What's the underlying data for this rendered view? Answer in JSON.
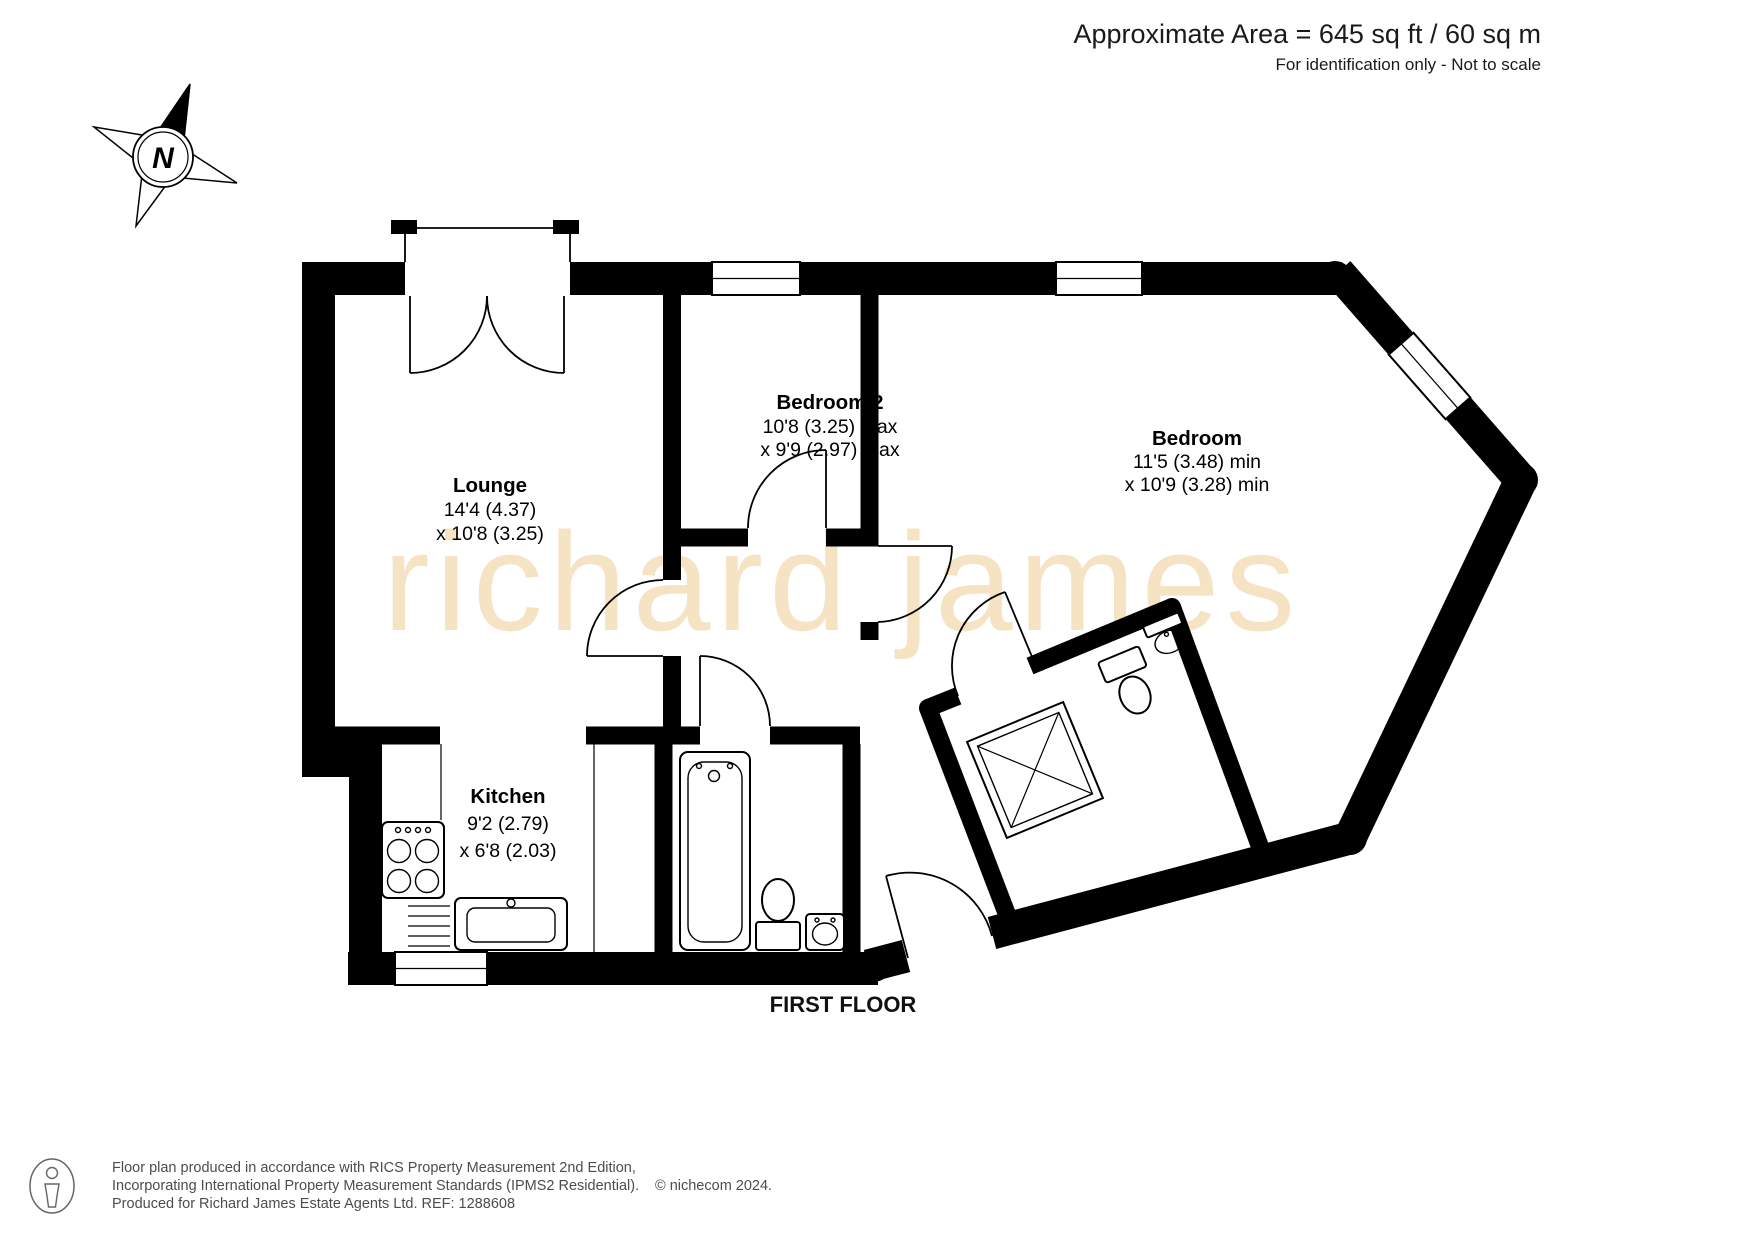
{
  "header": {
    "area": "Approximate Area = 645 sq ft / 60 sq m",
    "note": "For identification only - Not to scale"
  },
  "compass": {
    "north": "N"
  },
  "watermark": "richard james",
  "rooms": {
    "lounge": {
      "name": "Lounge",
      "dim1": "14'4 (4.37)",
      "dim2": "x 10'8 (3.25)"
    },
    "bedroom2": {
      "name": "Bedroom 2",
      "dim1": "10'8 (3.25) max",
      "dim2": "x 9'9 (2.97) max"
    },
    "bedroom": {
      "name": "Bedroom",
      "dim1": "11'5 (3.48) min",
      "dim2": "x 10'9 (3.28) min"
    },
    "kitchen": {
      "name": "Kitchen",
      "dim1": "9'2 (2.79)",
      "dim2": "x 6'8 (2.03)"
    }
  },
  "floor_label": "FIRST FLOOR",
  "footer": {
    "line1": "Floor plan produced in accordance with RICS Property Measurement 2nd Edition,",
    "line2": "Incorporating International Property Measurement Standards (IPMS2 Residential).",
    "copyright": "© nichecom 2024.",
    "line3": "Produced for Richard James Estate Agents Ltd.   REF: 1288608"
  },
  "colors": {
    "wall": "#000000",
    "watermark": "#f5e3c4",
    "header_text": "#1a1a1a",
    "footer_text": "#4d4d4d"
  }
}
